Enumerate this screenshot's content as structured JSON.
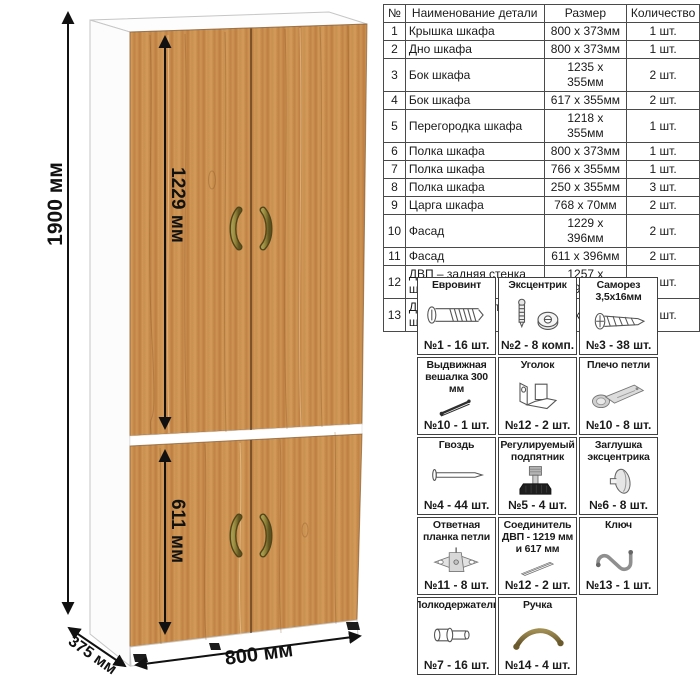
{
  "dimensions": {
    "height": "1900 мм",
    "upper_door": "1229 мм",
    "lower_door": "611 мм",
    "width": "800 мм",
    "depth": "375 мм"
  },
  "parts_table": {
    "headers": [
      "№",
      "Наименование детали",
      "Размер",
      "Количество"
    ],
    "rows": [
      [
        "1",
        "Крышка шкафа",
        "800 x 373мм",
        "1 шт."
      ],
      [
        "2",
        "Дно шкафа",
        "800 x 373мм",
        "1 шт."
      ],
      [
        "3",
        "Бок шкафа",
        "1235 x 355мм",
        "2 шт."
      ],
      [
        "4",
        "Бок шкафа",
        "617 x 355мм",
        "2 шт."
      ],
      [
        "5",
        "Перегородка шкафа",
        "1218 x 355мм",
        "1 шт."
      ],
      [
        "6",
        "Полка шкафа",
        "800 x 373мм",
        "1 шт."
      ],
      [
        "7",
        "Полка шкафа",
        "766 x 355мм",
        "1 шт."
      ],
      [
        "8",
        "Полка шкафа",
        "250 x 355мм",
        "3 шт."
      ],
      [
        "9",
        "Царга шкафа",
        "768 x 70мм",
        "2 шт."
      ],
      [
        "10",
        "Фасад",
        "1229 x 396мм",
        "2 шт."
      ],
      [
        "11",
        "Фасад",
        "611 x 396мм",
        "2 шт."
      ],
      [
        "12",
        "ДВП – задняя стенка шкафа",
        "1257 x 396мм",
        "2 шт."
      ],
      [
        "13",
        "ДВП – задняя стенка шкафа",
        "639 x 396мм",
        "2 шт."
      ]
    ]
  },
  "hardware": {
    "items": [
      {
        "title": "Евровинт",
        "icon": "euro-screw",
        "count": "№1 - 16 шт."
      },
      {
        "title": "Эксцентрик",
        "icon": "eccentric-cam",
        "count": "№2 - 8 комп."
      },
      {
        "title": "Саморез 3,5х16мм",
        "icon": "self-tapping-screw",
        "count": "№3 - 38 шт."
      },
      {
        "title": "Выдвижная вешалка 300 мм",
        "icon": "pull-out-hanger",
        "count": "№10 - 1 шт."
      },
      {
        "title": "Уголок",
        "icon": "corner-bracket",
        "count": "№12 - 2 шт."
      },
      {
        "title": "Плечо петли",
        "icon": "hinge-arm",
        "count": "№10 - 8 шт."
      },
      {
        "title": "Гвоздь",
        "icon": "nail",
        "count": "№4 - 44 шт."
      },
      {
        "title": "Регулируемый подпятник",
        "icon": "adjustable-foot",
        "count": "№5 - 4 шт."
      },
      {
        "title": "Заглушка эксцентрика",
        "icon": "cam-cover",
        "count": "№6 - 8 шт."
      },
      {
        "title": "Ответная планка петли",
        "icon": "hinge-mounting-plate",
        "count": "№11 - 8 шт."
      },
      {
        "title": "Соединитель ДВП - 1219 мм и 617 мм",
        "icon": "hdf-connector",
        "count": "№12 - 2 шт."
      },
      {
        "title": "Ключ",
        "icon": "hex-key",
        "count": "№13 - 1 шт."
      },
      {
        "title": "Полкодержатель",
        "icon": "shelf-pin",
        "count": "№7 - 16 шт."
      },
      {
        "title": "Ручка",
        "icon": "door-handle",
        "count": "№14 - 4 шт."
      }
    ]
  },
  "colors": {
    "wood": "#c9904f",
    "handle_bronze": "#8a7c33",
    "carcass": "#ffffff",
    "table_border": "#4a4a4a",
    "dimension_ink": "#111111"
  }
}
